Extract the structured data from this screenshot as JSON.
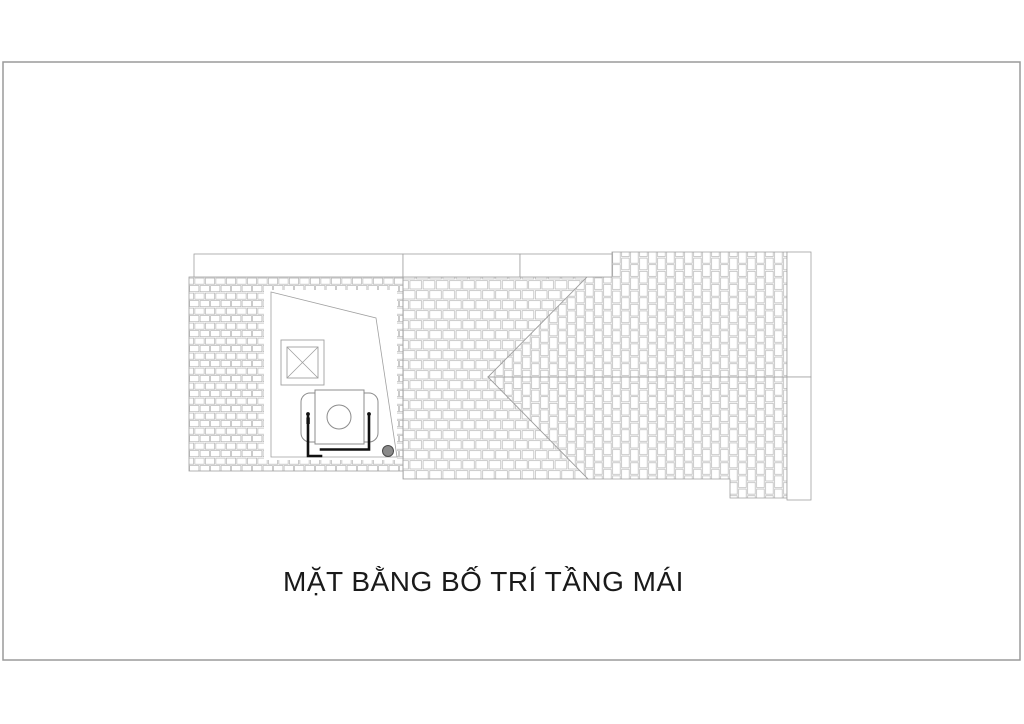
{
  "drawing": {
    "title": "MẶT BẰNG BỐ TRÍ TẦNG MÁI"
  },
  "colors": {
    "paper": "#ffffff",
    "frame_line": "#9a9a9a",
    "tile_line": "#b5b5b5",
    "edge_line": "#a0a0a0",
    "object_line": "#8c8c8c",
    "pipe_line": "#111111",
    "drain_fill": "#8a8a8a",
    "title_text": "#1a1a1a"
  }
}
